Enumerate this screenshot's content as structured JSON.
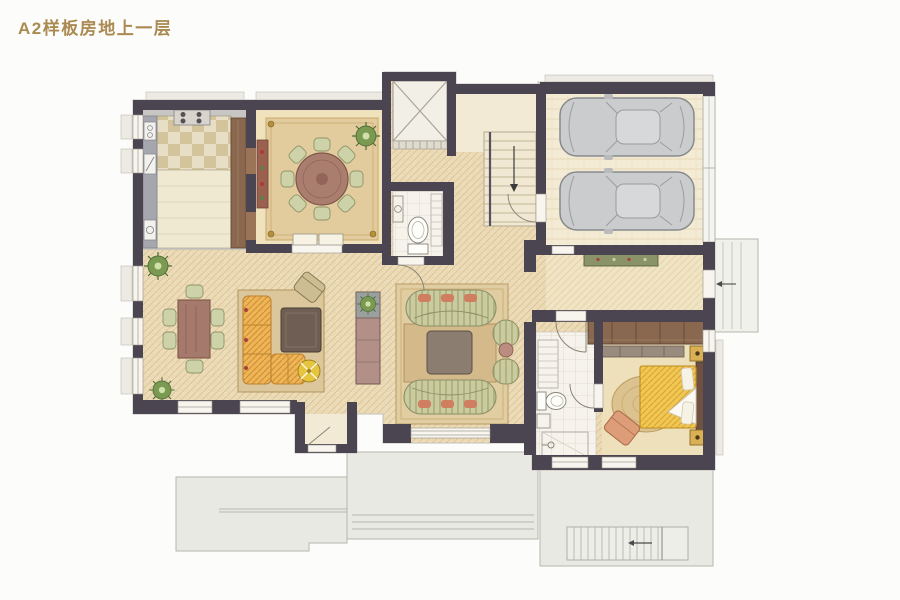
{
  "header": {
    "title": "A2样板房地上一层"
  },
  "palette": {
    "page-bg": "#fcfcfa",
    "title-gold": "#ab8a52",
    "wall": "#4a4550",
    "floor-weave": "#ecdcba",
    "floor-cream": "#f0e2bd",
    "rug-tan": "#e2cc9e",
    "terrace-gray": "#e9e9e4",
    "wood-cabinet": "#8a6850",
    "table-brown": "#a5796b",
    "chair-green": "#cdd2a8",
    "sofa-orange": "#edb558",
    "sofa-stripe-green": "#cacb9f",
    "coffee-table-dark": "#6f5e54",
    "bed-yellow": "#f0c654",
    "car-gray": "#caccce",
    "plant-green": "#7a9a52",
    "bath-tile": "#f6f3ec",
    "counter-gray": "#a6a6ae"
  }
}
